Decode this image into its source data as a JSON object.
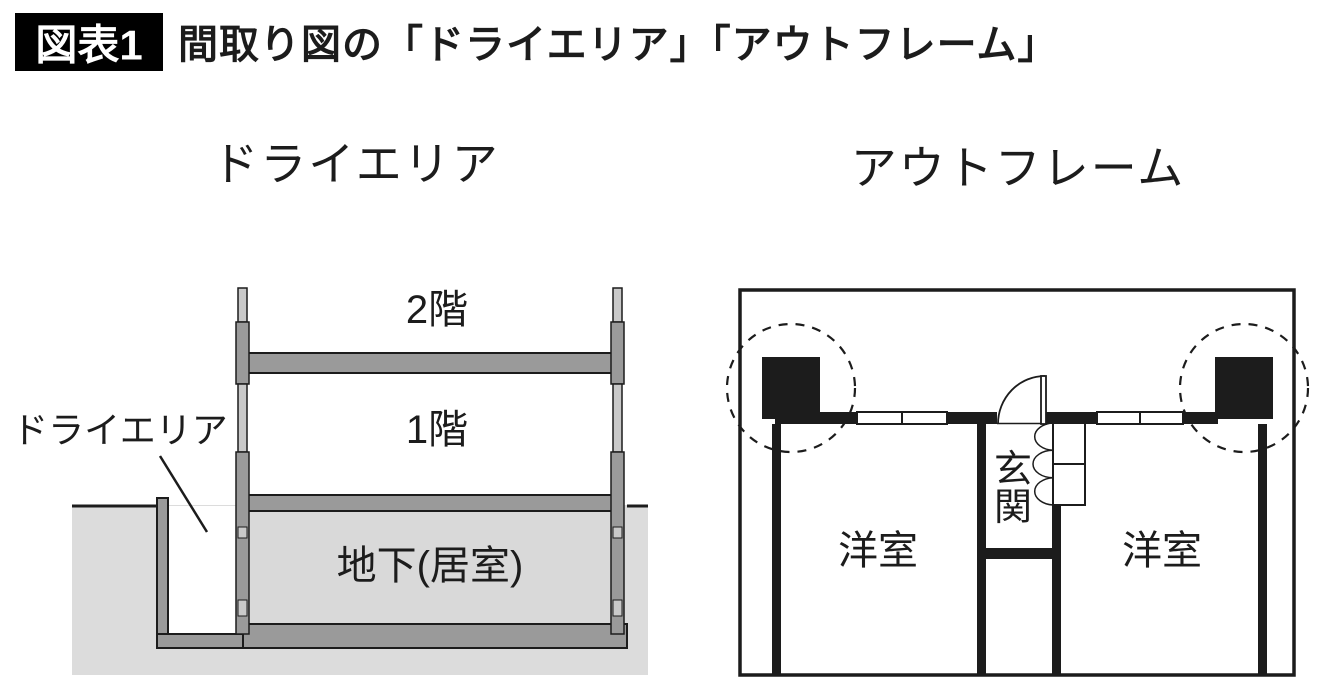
{
  "header": {
    "badge": "図表1",
    "title": "間取り図の「ドライエリア」「アウトフレーム」"
  },
  "dry_area_section": {
    "title": "ドライエリア",
    "label_floor2": "2階",
    "label_floor1": "1階",
    "label_basement": "地下(居室)",
    "callout_label": "ドライエリア"
  },
  "outframe_section": {
    "title": "アウトフレーム",
    "label_entrance_char1": "玄",
    "label_entrance_char2": "関",
    "label_room_left": "洋室",
    "label_room_right": "洋室"
  },
  "colors": {
    "line_black": "#1c1c1c",
    "wall_gray": "#9a9a9a",
    "wall_light_gray": "#c9c9c9",
    "ground_gray": "#dcdcdc",
    "basement_gray": "#d9d9d9",
    "badge_bg": "#000000",
    "badge_text": "#ffffff"
  }
}
